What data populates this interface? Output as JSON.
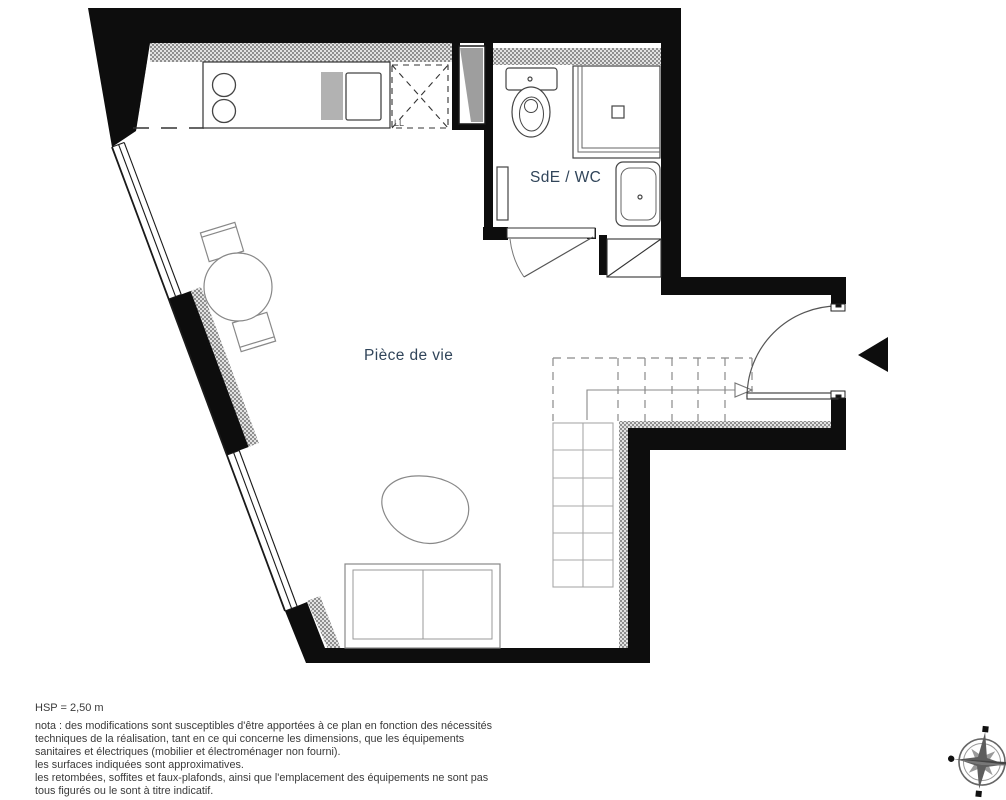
{
  "labels": {
    "living_room": "Pièce de vie",
    "bathroom": "SdE / WC",
    "washer": "LL",
    "ceiling_height": "HSP = 2,50 m"
  },
  "notes": [
    "nota : des modifications sont susceptibles d'être apportées à ce plan en fonction des nécessités",
    "techniques de la réalisation, tant en ce qui concerne les dimensions, que les équipements",
    "sanitaires et électriques (mobilier et électroménager non fourni).",
    "les surfaces indiquées sont approximatives.",
    "les retombées, soffites et faux-plafonds, ainsi que l'emplacement des équipements ne sont pas",
    "tous figurés ou le sont à titre indicatif."
  ],
  "icons": {
    "compass": "compass-rose",
    "entry_arrow": "entry-direction-arrow"
  },
  "colors": {
    "wall": "#0d0d0d",
    "label": "#31455a",
    "note": "#3a3a3a",
    "hatch": "#8f8f8f"
  }
}
